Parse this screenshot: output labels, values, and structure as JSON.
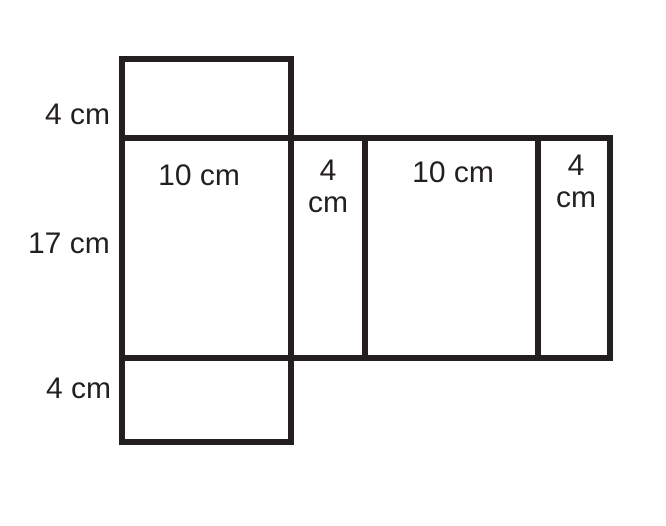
{
  "diagram": {
    "type": "net-of-rectangular-prism",
    "stroke_color": "#231f20",
    "background_color": "#ffffff",
    "side_labels": {
      "top_flap_height": "4 cm",
      "body_height": "17 cm",
      "bottom_flap_height": "4 cm"
    },
    "panel_labels": {
      "left_face_width": "10 cm",
      "left_strip_width_line1": "4",
      "left_strip_width_line2": "cm",
      "right_face_width": "10 cm",
      "right_strip_width_line1": "4",
      "right_strip_width_line2": "cm"
    }
  }
}
